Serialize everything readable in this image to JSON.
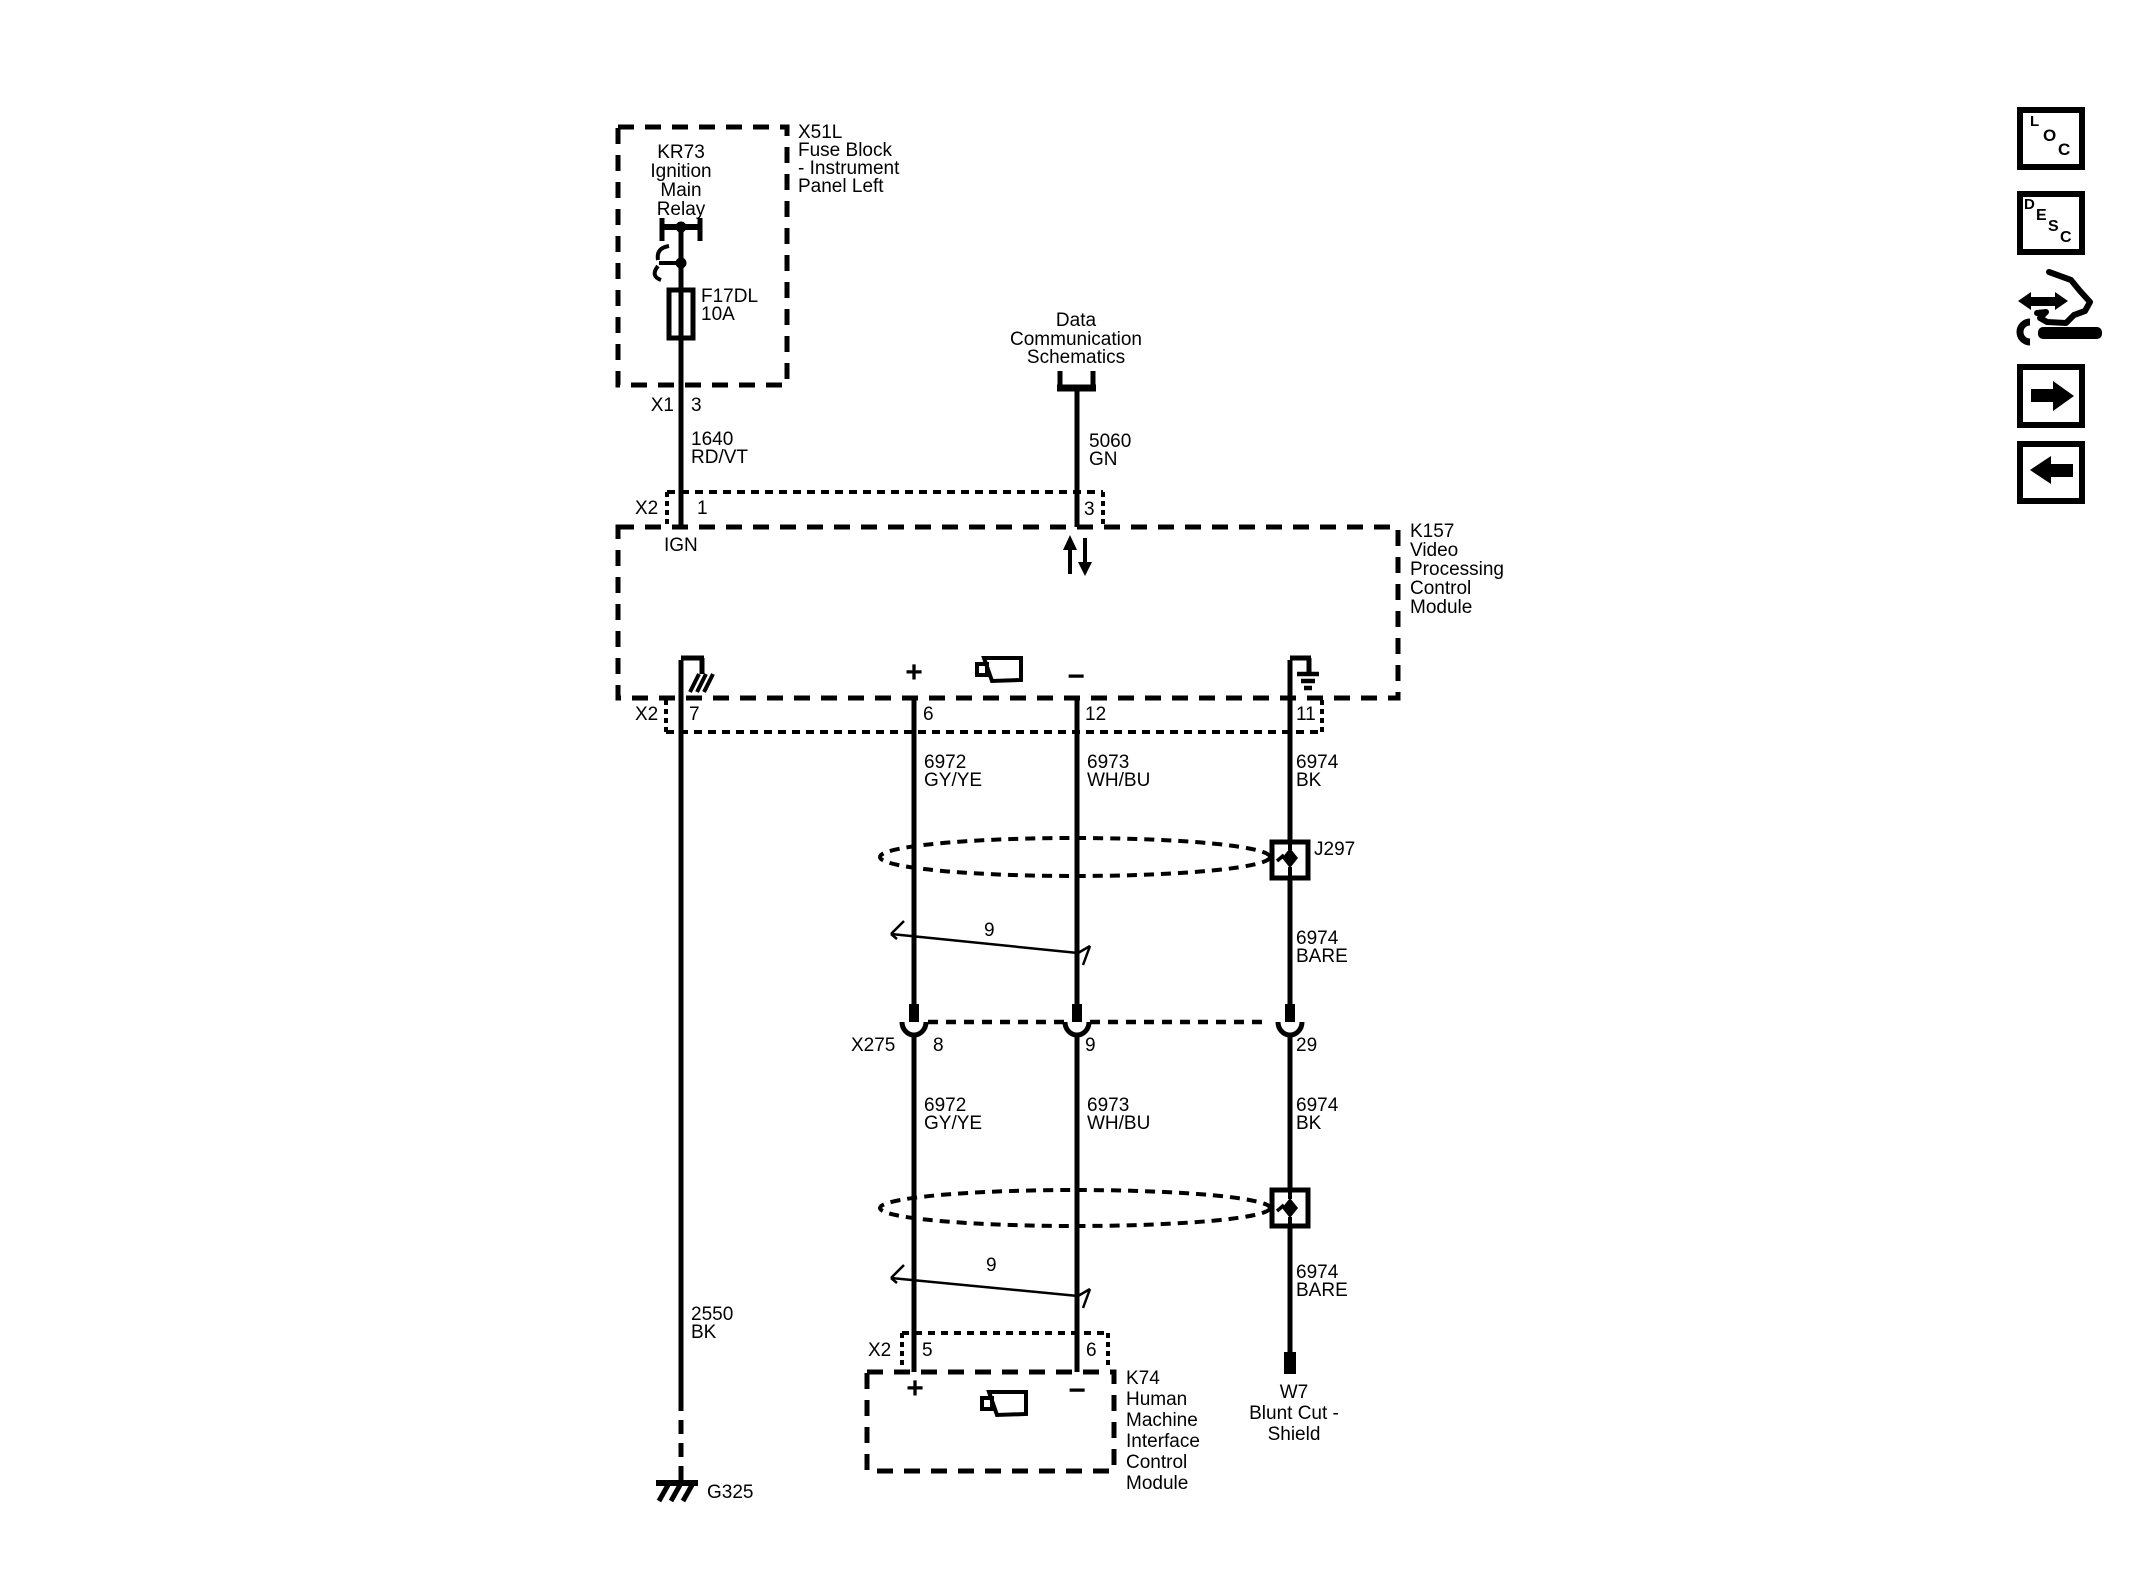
{
  "colors": {
    "line": "#000000",
    "background": "#ffffff"
  },
  "fuse_block": {
    "box_label": [
      "X51L",
      "Fuse Block",
      "- Instrument",
      "Panel Left"
    ],
    "relay_label": [
      "KR73",
      "Ignition",
      "Main",
      "Relay"
    ],
    "fuse_label": [
      "F17DL",
      "10A"
    ],
    "connector": "X1",
    "pin": "3"
  },
  "offpage_ref": {
    "label": [
      "Data",
      "Communication",
      "Schematics"
    ]
  },
  "wires": {
    "ignition": {
      "circuit": "1640",
      "color": "RD/VT"
    },
    "serial_data": {
      "circuit": "5060",
      "color": "GN"
    },
    "upper": [
      {
        "circuit": "6972",
        "color": "GY/YE"
      },
      {
        "circuit": "6973",
        "color": "WH/BU"
      },
      {
        "circuit": "6974",
        "color": "BK"
      }
    ],
    "upper_shield_bare": {
      "circuit": "6974",
      "color": "BARE"
    },
    "lower": [
      {
        "circuit": "6972",
        "color": "GY/YE"
      },
      {
        "circuit": "6973",
        "color": "WH/BU"
      },
      {
        "circuit": "6974",
        "color": "BK"
      }
    ],
    "lower_shield_bare": {
      "circuit": "6974",
      "color": "BARE"
    },
    "ground": {
      "circuit": "2550",
      "color": "BK"
    }
  },
  "k157": {
    "label": [
      "K157",
      "Video",
      "Processing",
      "Control",
      "Module"
    ],
    "top_connector": {
      "name": "X2",
      "ign_pin": "1",
      "ign_label": "IGN",
      "data_pin": "3"
    },
    "bottom_connector": {
      "name": "X2",
      "pins": [
        "7",
        "6",
        "12",
        "11"
      ]
    },
    "polarity": {
      "plus": "+",
      "minus": "−"
    }
  },
  "splice": {
    "label": "J297"
  },
  "twist": {
    "upper_count": "9",
    "lower_count": "9"
  },
  "x275": {
    "name": "X275",
    "pins": [
      "8",
      "9",
      "29"
    ]
  },
  "k74": {
    "label": [
      "K74",
      "Human",
      "Machine",
      "Interface",
      "Control",
      "Module"
    ],
    "connector": {
      "name": "X2",
      "plus_pin": "5",
      "minus_pin": "6"
    },
    "polarity": {
      "plus": "+",
      "minus": "−"
    }
  },
  "w7": {
    "label": [
      "W7",
      "Blunt Cut -",
      "Shield"
    ]
  },
  "ground_ref": {
    "label": "G325"
  },
  "sidebar": {
    "loc_letters": [
      "L",
      "O",
      "C"
    ],
    "desc_letters": [
      "D",
      "E",
      "S",
      "C"
    ],
    "icons": [
      "loc-button",
      "desc-button",
      "schematic-tools-button",
      "forward-button",
      "back-button"
    ]
  }
}
